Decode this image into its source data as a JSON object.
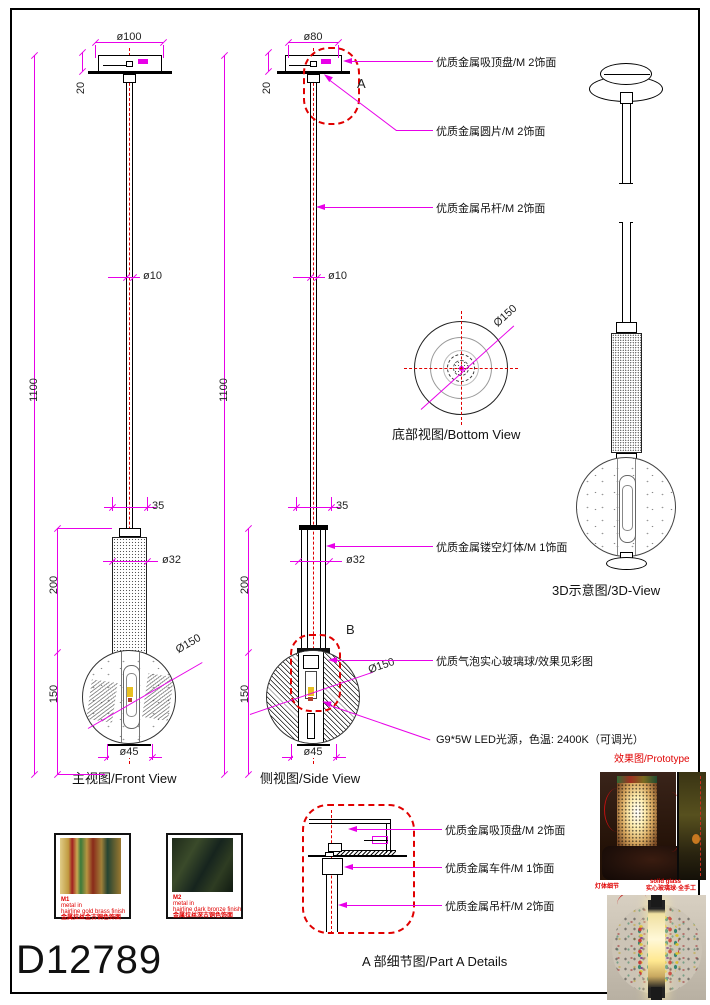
{
  "sheet": {
    "code": "D12789"
  },
  "views": {
    "front": {
      "label": "主视图/Front View"
    },
    "side": {
      "label": "侧视图/Side View"
    },
    "bottom": {
      "label": "底部视图/Bottom View"
    },
    "three_d": {
      "label": "3D示意图/3D-View"
    },
    "part_a": {
      "label": "A 部细节图/Part A Details"
    },
    "prototype": {
      "label": "效果图/Prototype"
    }
  },
  "markers": {
    "a": "A",
    "b": "B"
  },
  "dimensions": {
    "front": {
      "canopy_dia": "ø100",
      "canopy_h": "20",
      "overall": "1100",
      "rod_dia": "ø10",
      "neck_w": "35",
      "body_dia": "ø32",
      "body_h": "200",
      "ball_h": "150",
      "ball_dia": "Ø150",
      "cap_dia": "ø45"
    },
    "side": {
      "canopy_dia": "ø80",
      "canopy_h": "20",
      "overall": "1100",
      "rod_dia": "ø10",
      "neck_w": "35",
      "body_dia": "ø32",
      "body_h": "200",
      "ball_h": "150",
      "ball_dia": "Ø150",
      "cap_dia": "ø45"
    },
    "bottom": {
      "ball_dia": "Ø150"
    }
  },
  "annotations": {
    "ceiling_plate": "优质金属吸顶盘/M 2饰面",
    "metal_disc": "优质金属圆片/M 2饰面",
    "hanging_rod": "优质金属吊杆/M 2饰面",
    "hollow_body": "优质金属镂空灯体/M 1饰面",
    "glass_ball": "优质气泡实心玻璃球/效果见彩图",
    "led": "G9*5W LED光源，色温: 2400K（可调光）",
    "detail_plate": "优质金属吸顶盘/M 2饰面",
    "detail_turned": "优质金属车件/M 1饰面",
    "detail_rod": "优质金属吊杆/M 2饰面"
  },
  "materials": [
    {
      "code": "M1",
      "line1": "metal in",
      "line2": "hairline gold brass finish",
      "line3": "金属拉丝金古铜色饰面"
    },
    {
      "code": "M2",
      "line1": "metal in",
      "line2": "hairline dark bronze finish",
      "line3": "金属拉丝深古铜色饰面"
    }
  ],
  "prototype_notes": {
    "left": "灯体细节",
    "right_line1": "solid glass",
    "right_line2": "实心玻璃球·全手工"
  },
  "colors": {
    "dimension": "#e800e8",
    "centerline": "#e00000",
    "cloud": "#e00000",
    "line": "#000000",
    "note_red": "#e00000"
  }
}
